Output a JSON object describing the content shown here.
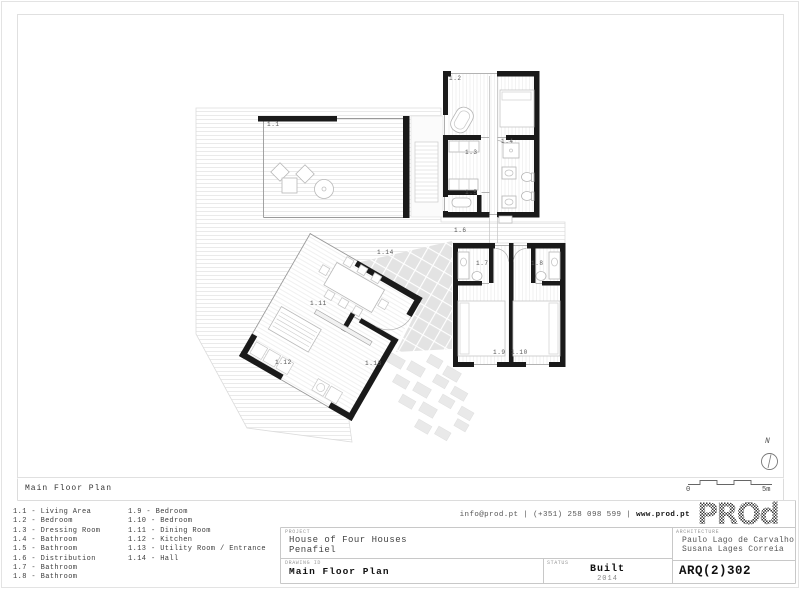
{
  "sheet": {
    "strip_label": "Main Floor Plan"
  },
  "plan": {
    "room_labels": [
      {
        "id": "1.1"
      },
      {
        "id": "1.2"
      },
      {
        "id": "1.3"
      },
      {
        "id": "1.4"
      },
      {
        "id": "1.5"
      },
      {
        "id": "1.6"
      },
      {
        "id": "1.7"
      },
      {
        "id": "1.8"
      },
      {
        "id": "1.9"
      },
      {
        "id": "1.10"
      },
      {
        "id": "1.11"
      },
      {
        "id": "1.12"
      },
      {
        "id": "1.13"
      },
      {
        "id": "1.14"
      }
    ],
    "north": "N",
    "scale": {
      "zero": "0",
      "five": "5m"
    }
  },
  "legend": {
    "column1": [
      "1.1 - Living Area",
      "1.2 - Bedroom",
      "1.3 - Dressing Room",
      "1.4 - Bathroom",
      "1.5 - Bathroom",
      "1.6 - Distribution",
      "1.7 - Bathroom",
      "1.8 - Bathroom"
    ],
    "column2": [
      "1.9 - Bedroom",
      "1.10 - Bedroom",
      "1.11 - Dining Room",
      "1.12 - Kitchen",
      "1.13 - Utility Room / Entrance",
      "1.14 - Hall"
    ]
  },
  "titleblock": {
    "contact_plain": "info@prod.pt | (+351) 258 098 599 |",
    "contact_bold": "www.prod.pt",
    "logo": "PROd",
    "project_label": "PROJECT",
    "project_name": "House of Four Houses",
    "project_location": "Penafiel",
    "drawing_label": "DRAWING ID",
    "drawing_name": "Main Floor Plan",
    "status_label": "STATUS",
    "status_value": "Built",
    "status_year": "2014",
    "architecture_label": "ARCHITECTURE",
    "architect_1": "Paulo Lago de Carvalho",
    "architect_2": "Susana Lages Correia",
    "code": "ARQ(2)302"
  }
}
